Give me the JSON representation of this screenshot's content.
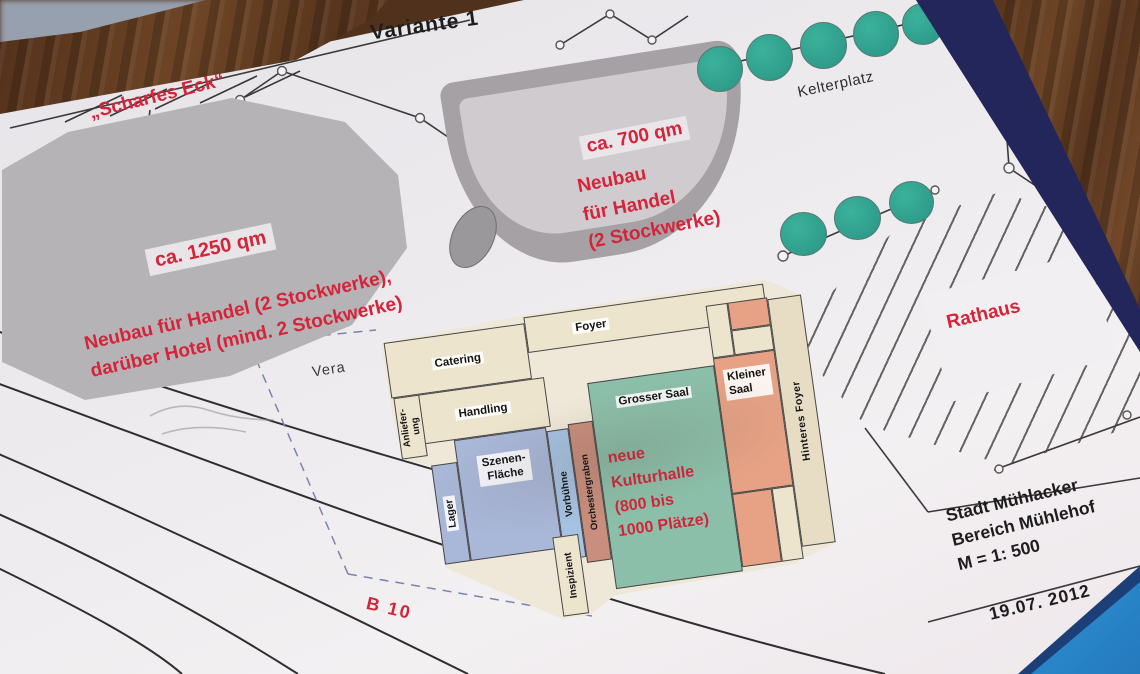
{
  "title": {
    "variante": "Variante 1"
  },
  "streets": {
    "scharfes_eck": "„Scharfes Eck“",
    "kelterplatz": "Kelterplatz",
    "b10": "B 10",
    "vera": "Vera"
  },
  "annotations": {
    "area_1250": "ca. 1250 qm",
    "neubau_1250_l1": "Neubau für Handel (2 Stockwerke),",
    "neubau_1250_l2": "darüber Hotel (mind. 2 Stockwerke)",
    "area_700": "ca. 700 qm",
    "neubau_700_l1": "Neubau",
    "neubau_700_l2": "für Handel",
    "neubau_700_l3": "(2 Stockwerke)",
    "rathaus": "Rathaus",
    "kulturhalle_l1": "neue",
    "kulturhalle_l2": "Kulturhalle",
    "kulturhalle_l3": "(800 bis",
    "kulturhalle_l4": "1000 Plätze)"
  },
  "rooms": {
    "foyer": "Foyer",
    "catering": "Catering",
    "handling": "Handling",
    "anlieferung_l1": "Anliefer-",
    "anlieferung_l2": "ung",
    "szenen_l1": "Szenen-",
    "szenen_l2": "Fläche",
    "lager": "Lager",
    "vorbuehne": "Vorbühne",
    "orchestergraben": "Orchestergraben",
    "inspizient": "Inspizient",
    "grosser_saal": "Grosser Saal",
    "kleiner_saal_l1": "Kleiner",
    "kleiner_saal_l2": "Saal",
    "hinteres_foyer": "Hinteres Foyer"
  },
  "stamp": {
    "l1": "Stadt Mühlacker",
    "l2": "Bereich Mühlehof",
    "l3": "M = 1: 500",
    "date": "19.07. 2012"
  },
  "colors": {
    "annotation_red": "#d5243a",
    "tree_green": "#2fa08e",
    "hall_green": "#8cbfa9",
    "salmon_room": "#e7a285",
    "blue_room": "#a9b7d8",
    "beige_room": "#ece4cc",
    "paper": "#edeaee",
    "gray_building": "#b6b3b7",
    "wood_brown": "#6e4526",
    "binder_navy": "#23265a",
    "binder_blue": "#2b8fd2"
  }
}
